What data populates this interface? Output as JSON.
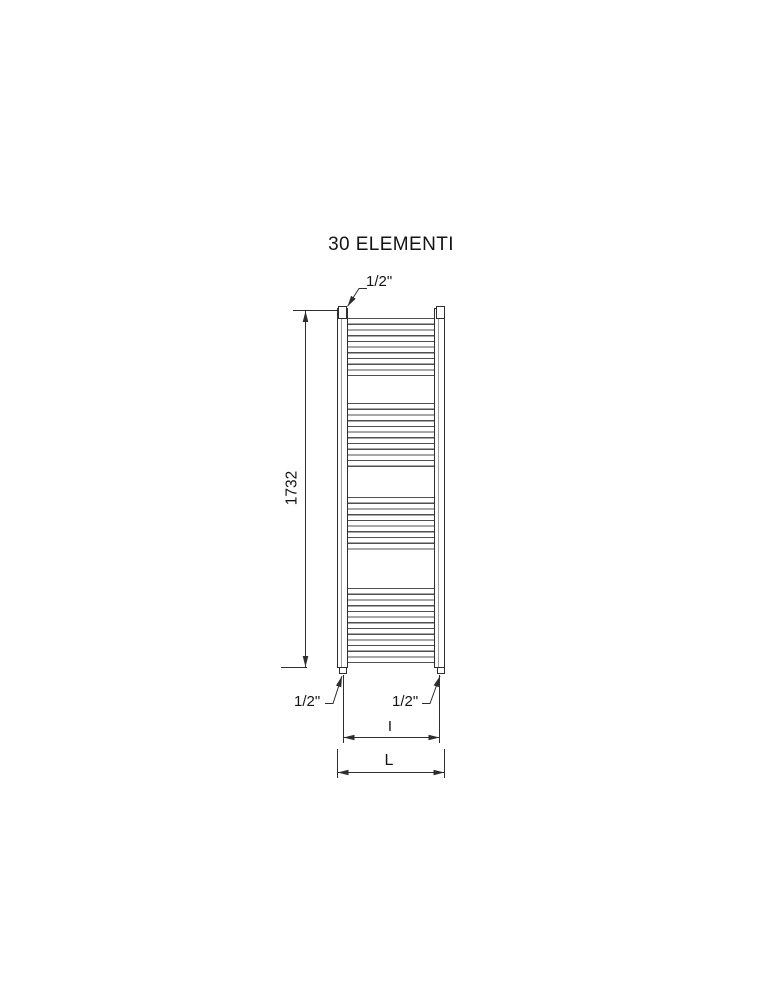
{
  "title": "30 ELEMENTI",
  "dims": {
    "height": "1732",
    "conn_top": "1/2\"",
    "conn_bottom_left": "1/2\"",
    "conn_bottom_right": "1/2\"",
    "interaxis": "I",
    "width": "L"
  },
  "radiator": {
    "elements": 30,
    "bands": [
      {
        "top": 318,
        "tubes": 10
      },
      {
        "top": 403,
        "tubes": 11
      },
      {
        "top": 497,
        "tubes": 9
      },
      {
        "top": 588,
        "tubes": 13
      }
    ]
  },
  "colors": {
    "line": "#2d2d2d",
    "tube_line": "#4f4f4f",
    "text": "#141414",
    "background": "#ffffff"
  }
}
